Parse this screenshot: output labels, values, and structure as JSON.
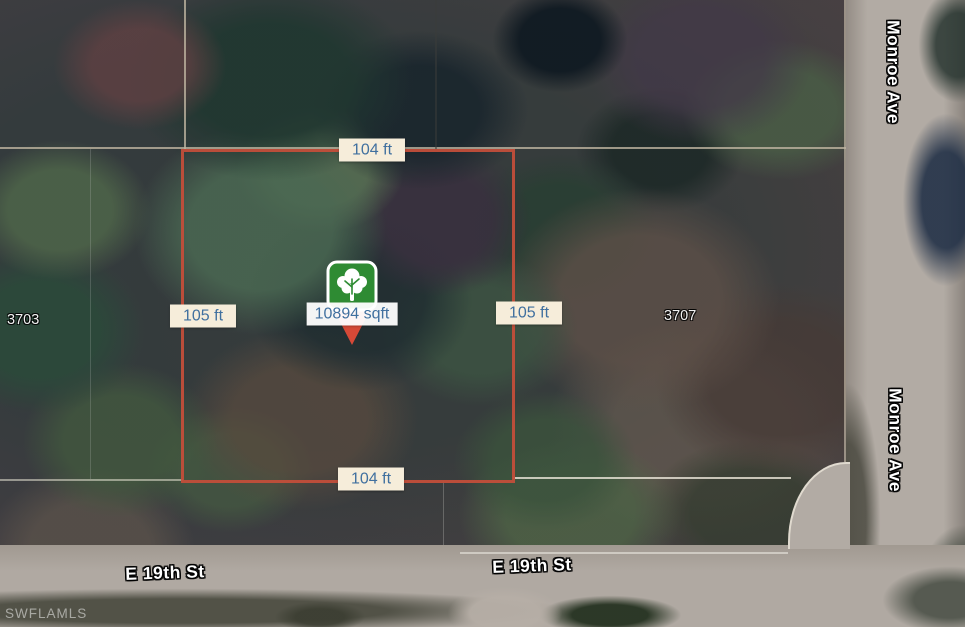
{
  "map": {
    "watermark": "SWFLAMLS",
    "area_label": "10894 sqft",
    "dimensions": {
      "top": "104 ft",
      "bottom": "104 ft",
      "left": "105 ft",
      "right": "105 ft"
    },
    "parcel_numbers": {
      "left": "3703",
      "right": "3707"
    },
    "streets": {
      "monroe_ave": "Monroe Ave",
      "e_19th_st": "E 19th St"
    },
    "marker": {
      "icon": "tree-icon",
      "pin_green": "#2e8b33",
      "pin_red": "#d64937"
    },
    "colors": {
      "lot_outline": "#c24e3c",
      "dimension_label_bg": "#f6edda",
      "dimension_label_text": "#40709f",
      "parcel_line": "#beb4a0",
      "road": "#b2aba4"
    }
  }
}
